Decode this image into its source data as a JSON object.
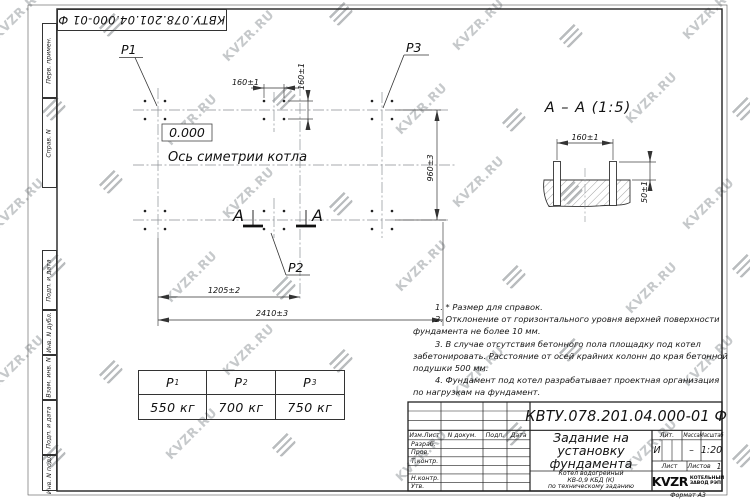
{
  "watermark": {
    "text": "KVZR.RU"
  },
  "stamp_top": {
    "doc_number": "КВТУ.078.201.04.000-01 Ф"
  },
  "margin_labels": [
    "Перв. примен.",
    "Справ. N",
    "Подп. и дата",
    "Инв. N дубл.",
    "Взам. инв. N",
    "Подп. и дата",
    "Инв. N подл."
  ],
  "plan": {
    "elevation": "0.000",
    "axis_label": "Ось симетрии котла",
    "labels": {
      "p1": "P1",
      "p2": "P2",
      "p3": "P3"
    },
    "section_letter_left": "А",
    "section_letter_right": "А",
    "dims": {
      "bolt_spacing_h": "160±1",
      "bolt_spacing_v": "160±1",
      "width": "960±3",
      "half_length": "1205±2",
      "length": "2410±3"
    }
  },
  "section": {
    "title": "А – А (1:5)",
    "dims": {
      "bolt_spacing": "160±1",
      "protrusion": "50±1"
    }
  },
  "notes": {
    "lines": [
      "1. * Размер для справок.",
      "2. Отклонение от горизонтального уровня верхней поверхности",
      "фундамента не более 10 мм.",
      "3. В случае отсутствия бетонного пола площадку под котел",
      "забетонировать. Расстояние от осей крайних колонн до края бетонной",
      "подушки 500 мм.",
      "4. Фундамент под котел разрабатывает проектная организация",
      "по нагрузкам на фундамент."
    ]
  },
  "load_table": {
    "columns": [
      {
        "head": "Р",
        "sub": "1",
        "value": "550 кг"
      },
      {
        "head": "Р",
        "sub": "2",
        "value": "700 кг"
      },
      {
        "head": "Р",
        "sub": "3",
        "value": "750 кг"
      }
    ]
  },
  "title_block": {
    "doc_number": "КВТУ.078.201.04.000-01 Ф",
    "title_lines": [
      "Задание на",
      "установку",
      "фундамента"
    ],
    "subtitle_lines": [
      "Котел водогрейный",
      "КВ-0,9 КБД (К)",
      "по техническому заданию"
    ],
    "header_cells": [
      "Изм.Лист",
      "N докум.",
      "Подп.",
      "Дата"
    ],
    "row_labels": [
      "Разраб.",
      "Пров.",
      "Т.контр.",
      "Н.контр.",
      "Утв."
    ],
    "lit_label": "Лит.",
    "lit_value": "И",
    "mass_label": "Масса",
    "mass_value": "–",
    "scale_label": "Масштаб",
    "scale_value": "1:20",
    "sheet_label": "Лист",
    "sheets_label": "Листов",
    "sheets_value": "1",
    "company": {
      "logo_text": "KVZR",
      "name_lines": [
        "КОТЕЛЬНЫЙ",
        "ЗАВОД РЭП"
      ]
    },
    "format_label": "Формат А3"
  }
}
